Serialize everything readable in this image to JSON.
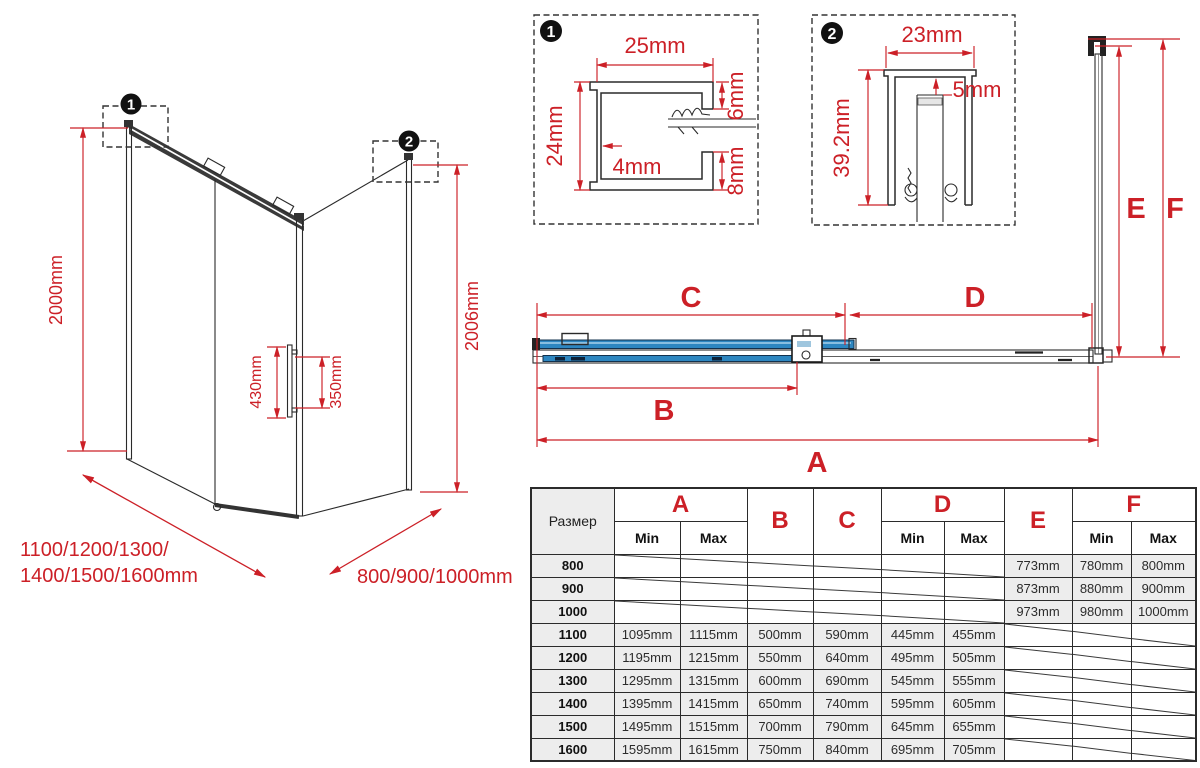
{
  "colors": {
    "red": "#cc2027",
    "ink": "#2a2a2a",
    "blue": "#2d86c0",
    "blue_dark": "#12314d",
    "cell": "#ededed"
  },
  "iso": {
    "marker1": "1",
    "marker2": "2",
    "height_left": "2000mm",
    "height_right": "2006mm",
    "handle_height": "430mm",
    "handle_offset": "350mm",
    "width_label_line1": "1100/1200/1300/",
    "width_label_line2": "1400/1500/1600mm",
    "depth_label": "800/900/1000mm"
  },
  "detail1": {
    "marker": "1",
    "width": "25mm",
    "height": "24mm",
    "wall": "4mm",
    "top_gap": "6mm",
    "bottom_gap": "8mm"
  },
  "detail2": {
    "marker": "2",
    "width": "23mm",
    "gap": "5mm",
    "height": "39.2mm"
  },
  "plan": {
    "dim_a": "A",
    "dim_b": "B",
    "dim_c": "C",
    "dim_d": "D",
    "dim_e": "E",
    "dim_f": "F"
  },
  "table": {
    "size_header": "Размер",
    "min_label": "Min",
    "max_label": "Max",
    "col_groups": [
      {
        "label": "A",
        "span": 2
      },
      {
        "label": "B",
        "span": 1
      },
      {
        "label": "C",
        "span": 1
      },
      {
        "label": "D",
        "span": 2
      },
      {
        "label": "E",
        "span": 1
      },
      {
        "label": "F",
        "span": 2
      }
    ],
    "rows": [
      {
        "size": "800",
        "cells": [
          null,
          null,
          null,
          null,
          null,
          null,
          "773mm",
          "780mm",
          "800mm"
        ]
      },
      {
        "size": "900",
        "cells": [
          null,
          null,
          null,
          null,
          null,
          null,
          "873mm",
          "880mm",
          "900mm"
        ]
      },
      {
        "size": "1000",
        "cells": [
          null,
          null,
          null,
          null,
          null,
          null,
          "973mm",
          "980mm",
          "1000mm"
        ]
      },
      {
        "size": "1100",
        "cells": [
          "1095mm",
          "1115mm",
          "500mm",
          "590mm",
          "445mm",
          "455mm",
          null,
          null,
          null
        ]
      },
      {
        "size": "1200",
        "cells": [
          "1195mm",
          "1215mm",
          "550mm",
          "640mm",
          "495mm",
          "505mm",
          null,
          null,
          null
        ]
      },
      {
        "size": "1300",
        "cells": [
          "1295mm",
          "1315mm",
          "600mm",
          "690mm",
          "545mm",
          "555mm",
          null,
          null,
          null
        ]
      },
      {
        "size": "1400",
        "cells": [
          "1395mm",
          "1415mm",
          "650mm",
          "740mm",
          "595mm",
          "605mm",
          null,
          null,
          null
        ]
      },
      {
        "size": "1500",
        "cells": [
          "1495mm",
          "1515mm",
          "700mm",
          "790mm",
          "645mm",
          "655mm",
          null,
          null,
          null
        ]
      },
      {
        "size": "1600",
        "cells": [
          "1595mm",
          "1615mm",
          "750mm",
          "840mm",
          "695mm",
          "705mm",
          null,
          null,
          null
        ]
      }
    ]
  }
}
